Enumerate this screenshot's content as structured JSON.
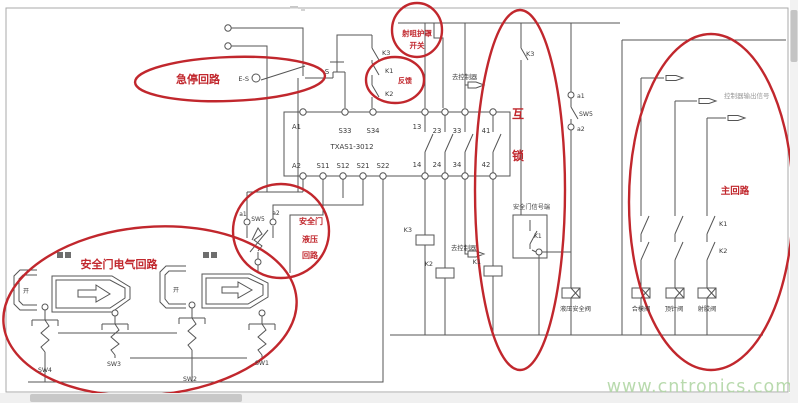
{
  "canvas": {
    "watermark": "www.cntronics.com",
    "accent_red": "#c1272d",
    "line_color": "#555555",
    "watermark_color": "#b2d7a6"
  },
  "ann": {
    "estop_loop": "急停回路",
    "guard1": "射咀护罩",
    "guard2": "开关",
    "feedback": "反馈",
    "inter1": "互",
    "inter2": "锁",
    "door_elec": "安全门电气回路",
    "hyd1": "安全门",
    "hyd2": "液压",
    "hyd3": "回路",
    "main": "主回路"
  },
  "relay": {
    "model": "TXAS1-3012",
    "a1": "A1",
    "a2": "A2",
    "s33": "S33",
    "s34": "S34",
    "s11": "S11",
    "s12": "S12",
    "s21": "S21",
    "s22": "S22",
    "c13": "13",
    "c23": "23",
    "c33": "33",
    "c41": "41",
    "c14": "14",
    "c24": "24",
    "c34": "34",
    "c42": "42"
  },
  "dev": {
    "estop": "E-S",
    "s_button": "S",
    "k3_top": "K3",
    "k1_fb": "K1",
    "k2_fb": "K2",
    "to_ctrl_top": "去控制器",
    "to_ctrl_mid": "去控制器",
    "k3_mid": "K3",
    "a1": "a1",
    "sw5": "SW5",
    "a2": "a2",
    "sig_box": "安全门信号端",
    "k1_sig": "K1",
    "coil_k3": "K3",
    "coil_k2": "K2",
    "coil_k1": "K1",
    "k1_main": "K1",
    "k2_main": "K2",
    "ctrl_out": "控制器输出信号"
  },
  "hyd": {
    "a1": "a1",
    "sw5": "SW5",
    "a2": "a2"
  },
  "valves": {
    "safety": "液压安全阀",
    "clamp": "合模阀",
    "ejector": "顶针阀",
    "inject": "射胶阀"
  },
  "sw": {
    "sw1": "SW1",
    "sw2": "SW2",
    "sw3": "SW3",
    "sw4": "SW4"
  },
  "doors": {
    "open1": "开",
    "open2": "开"
  }
}
